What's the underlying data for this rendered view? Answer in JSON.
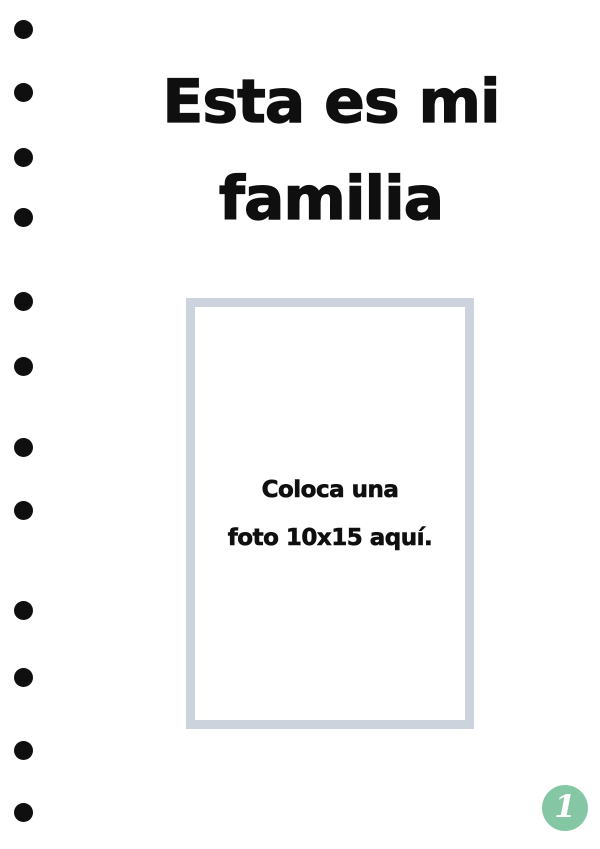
{
  "document": {
    "title": {
      "line1": "Esta es mi",
      "line2": "familia"
    },
    "photo_placeholder": {
      "line1": "Coloca una",
      "line2": "foto 10x15 aquí."
    },
    "page_number": "1",
    "binder_dots_count": 12
  },
  "colors": {
    "text": "#0f0f0f",
    "frame_border": "#ccd3dd",
    "badge_background": "#85c7a4",
    "badge_text": "#ffffff",
    "page_background": "#ffffff"
  },
  "layout_data": {
    "binder_dot_y": [
      29,
      92,
      157,
      217,
      301,
      366,
      447,
      510,
      610,
      677,
      750,
      812
    ]
  }
}
